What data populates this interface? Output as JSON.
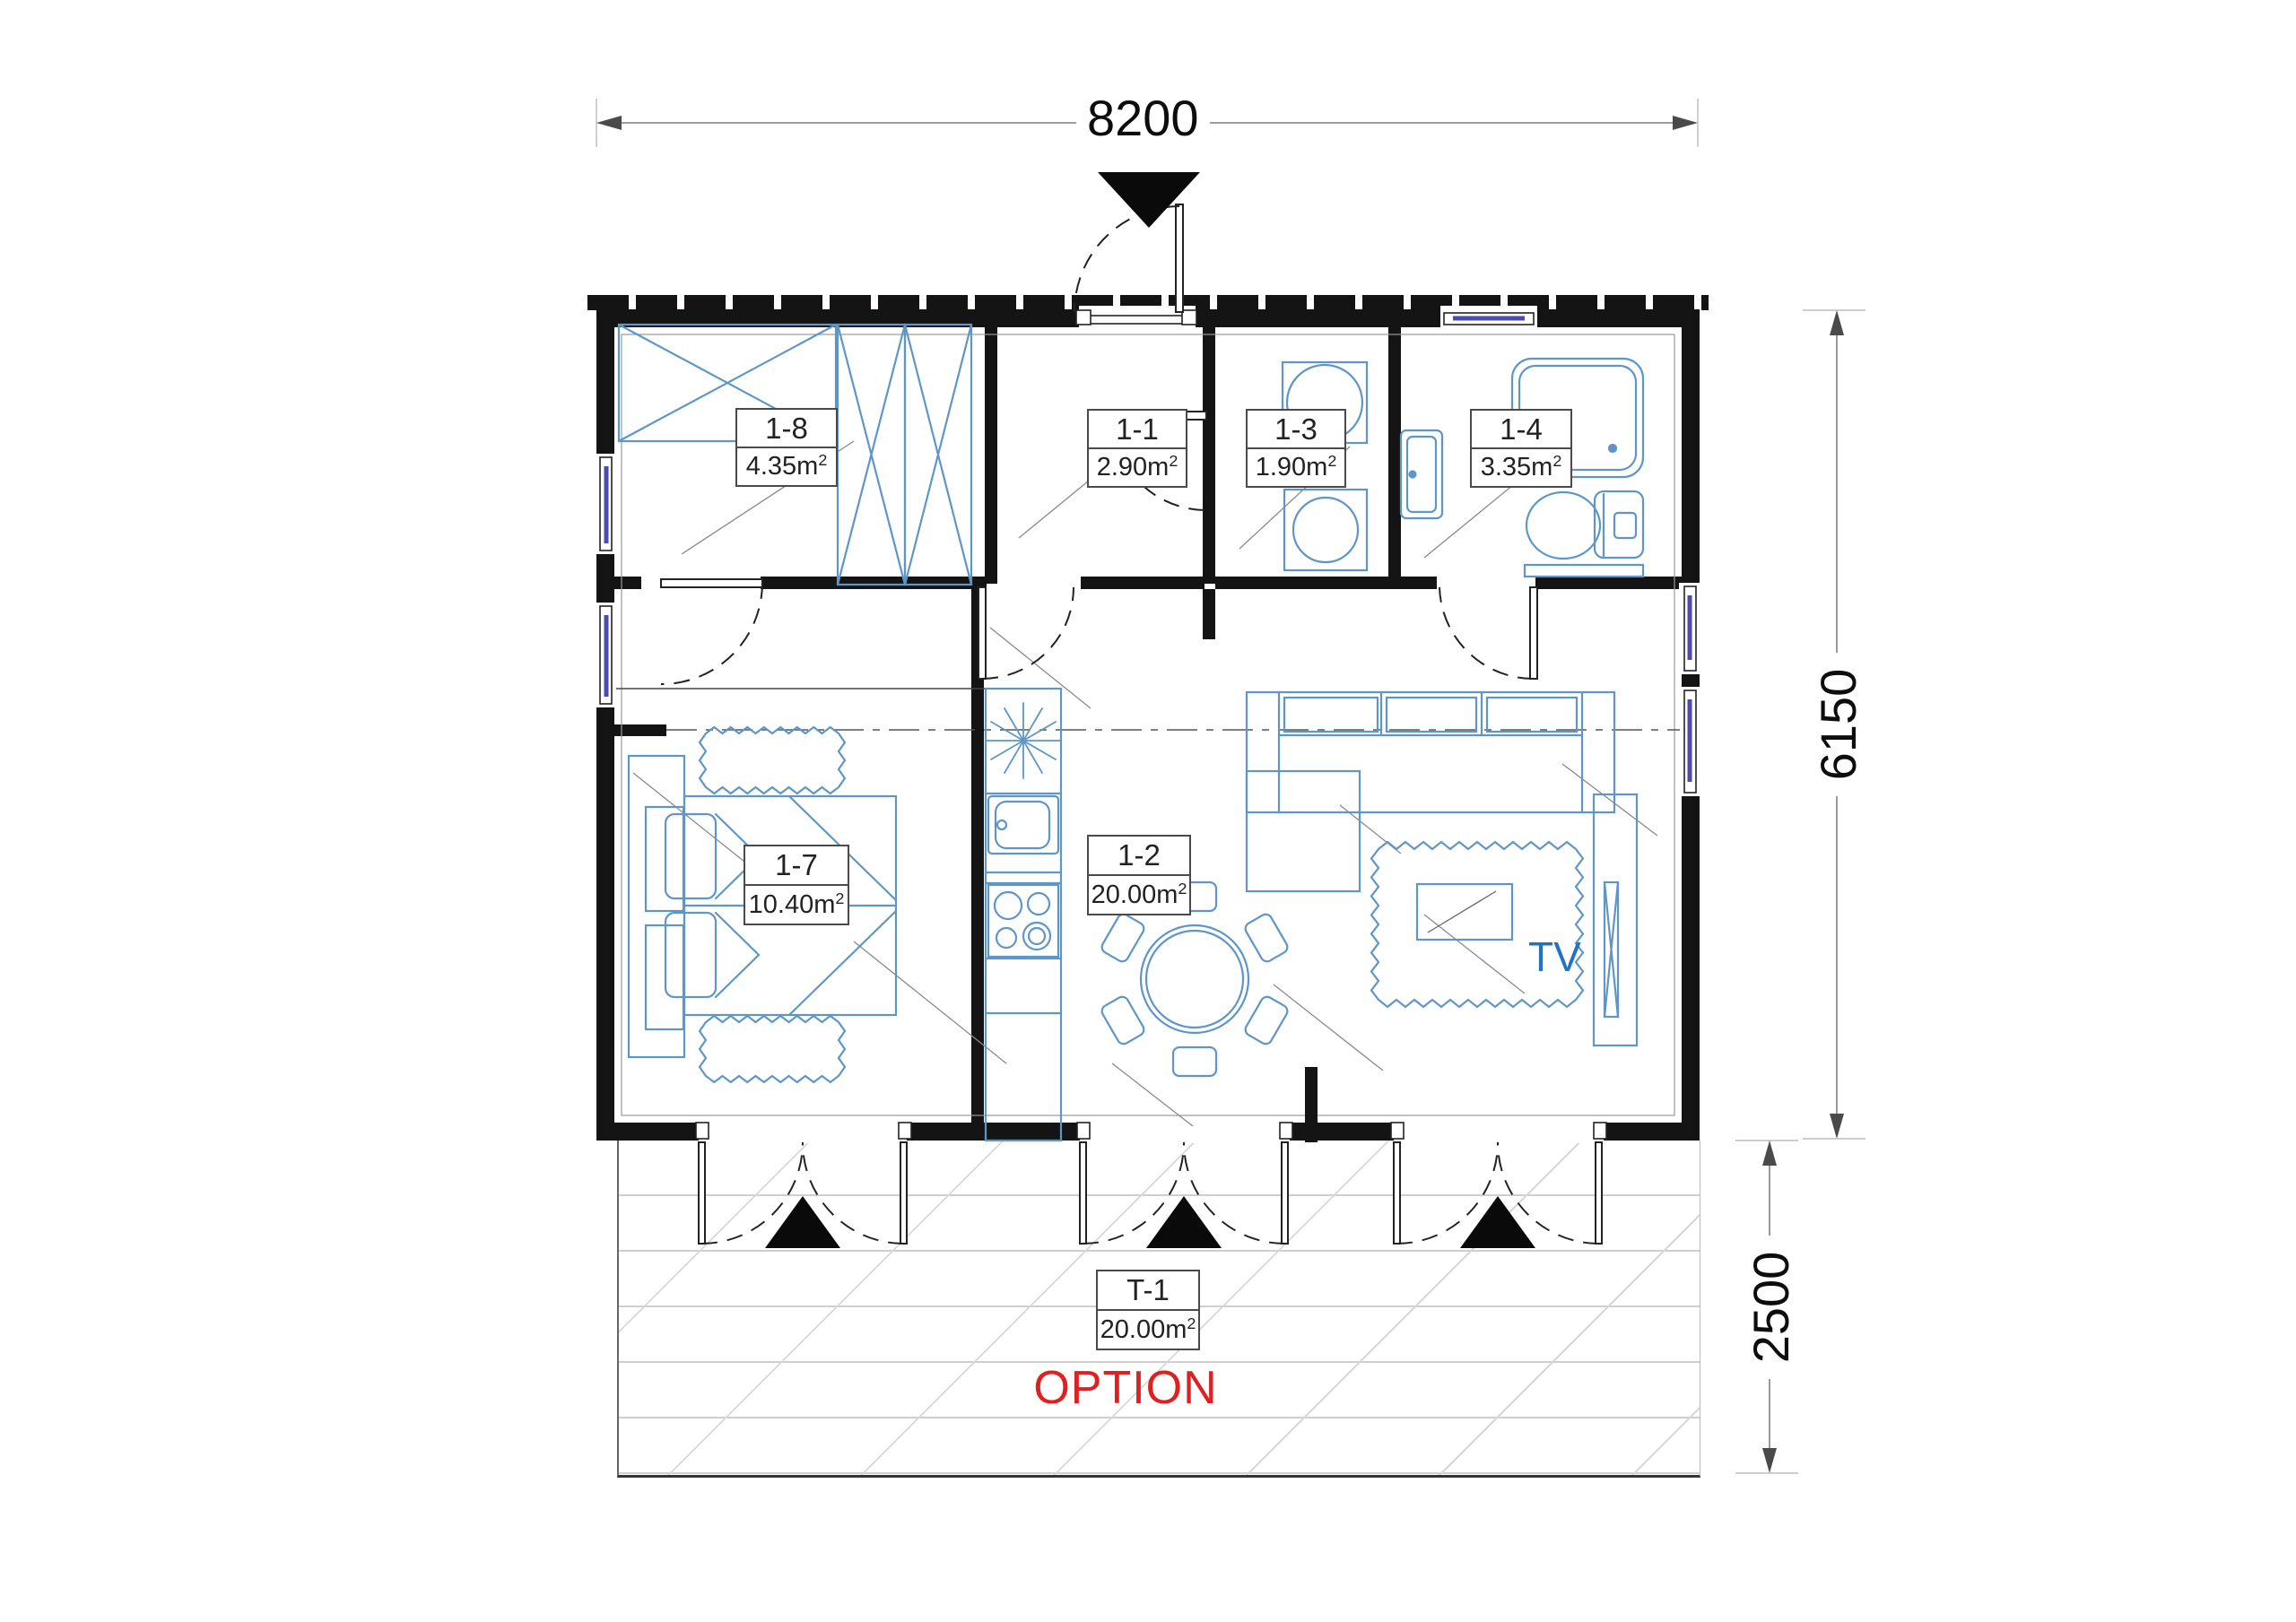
{
  "drawing": {
    "dimensions": {
      "width": "8200",
      "height": "6150",
      "terrace_depth": "2500"
    },
    "rooms": [
      {
        "code": "1-8",
        "area": "4.35"
      },
      {
        "code": "1-1",
        "area": "2.90"
      },
      {
        "code": "1-3",
        "area": "1.90"
      },
      {
        "code": "1-4",
        "area": "3.35"
      },
      {
        "code": "1-7",
        "area": "10.40"
      },
      {
        "code": "1-2",
        "area": "20.00"
      }
    ],
    "terrace_room": {
      "code": "T-1",
      "area": "20.00"
    },
    "area_unit": {
      "base": "m",
      "exp": "2"
    },
    "labels": {
      "tv": "TV",
      "option": "OPTION"
    },
    "colors": {
      "wall": "#141414",
      "furniture": "#5e96c8",
      "glazing": "#4b4bb0",
      "tv_text": "#2272c3",
      "option_text": "#e02020",
      "dimension_line": "#8f8f8f",
      "terrace_plank": "#cfcfcf"
    }
  }
}
